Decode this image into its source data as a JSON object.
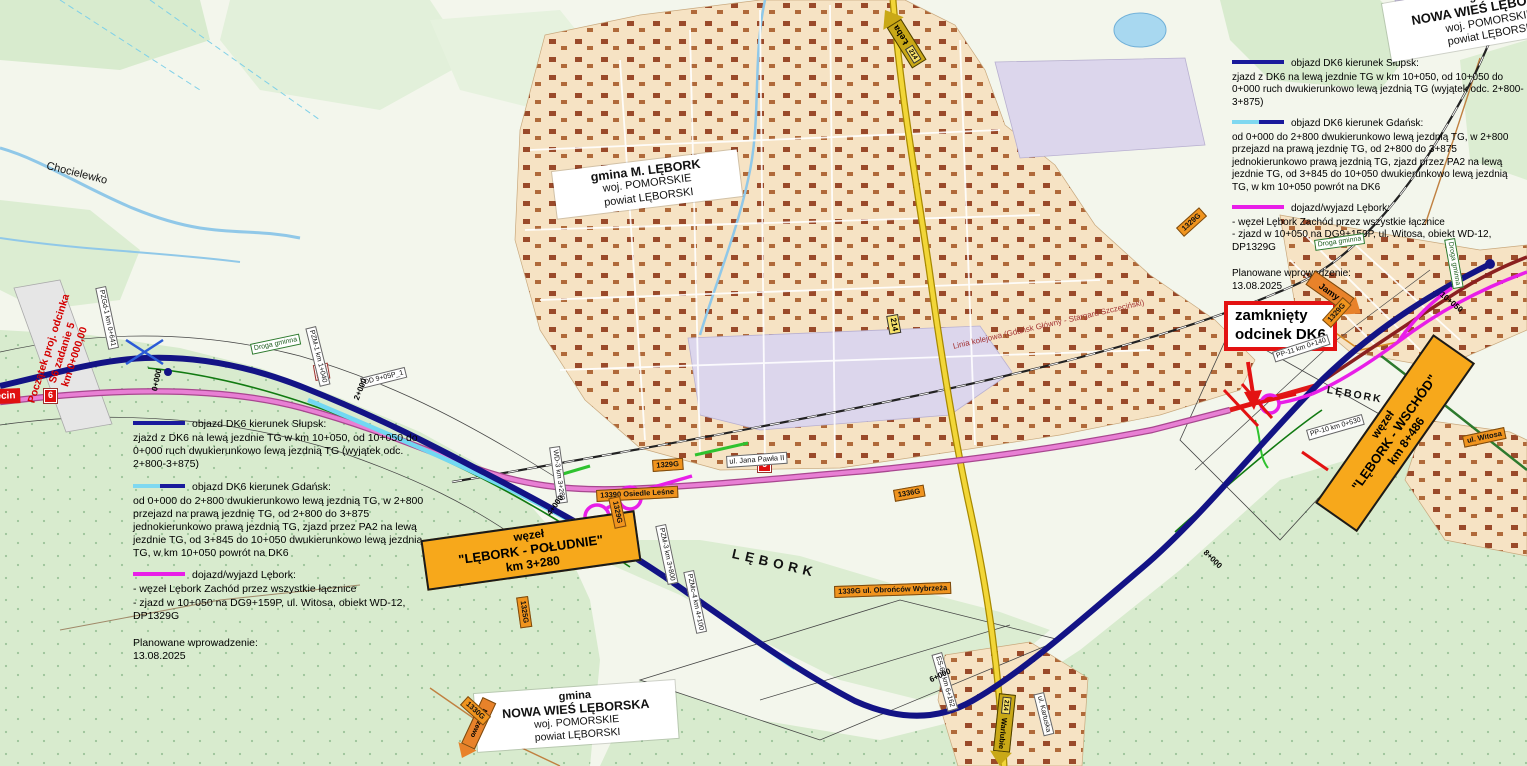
{
  "legend": {
    "items": [
      {
        "title": "objazd DK6 kierunek Słupsk:",
        "body": "zjazd z DK6 na lewą jezdnie TG w km 10+050, od 10+050 do 0+000 ruch dwukierunkowo lewą jezdnią TG (wyjątek odc. 2+800-3+875)",
        "color": "#1a1a9c"
      },
      {
        "title": "objazd DK6 kierunek Gdańsk:",
        "body": "od 0+000 do 2+800 dwukierunkowo lewą jezdnią TG, w 2+800 przejazd na prawą jezdnię TG, od 2+800 do 3+875 jednokierunkowo prawą jezdnią TG, zjazd przez PA2 na lewą jezdnie TG, od 3+845 do 10+050 dwukierunkowo lewą jezdnią TG, w km 10+050 powrót na DK6",
        "color": "#7fd8f0",
        "color2": "#1a1a9c"
      },
      {
        "title": "dojazd/wyjazd Lębork:",
        "body": "- węzeł Lębork Zachód przez wszystkie łącznice",
        "body2": "- zjazd w 10+050 na DG9+159P, ul. Witosa, obiekt WD-12, DP1329G",
        "color": "#e81ee8"
      }
    ],
    "footer_label": "Planowane wprowadzenie:",
    "footer_date": "13.08.2025"
  },
  "regions": [
    {
      "prefix": "gmina",
      "name": "NOWA WIEŚ LĘBORSKA",
      "voivodeship": "woj. POMORSKIE",
      "county": "powiat LĘBORSKI"
    },
    {
      "prefix": "",
      "name": "gmina M. LĘBORK",
      "voivodeship": "woj. POMORSKIE",
      "county": "powiat LĘBORSKI"
    },
    {
      "prefix": "gmina",
      "name": "NOWA WIEŚ LĘBORSKA",
      "voivodeship": "woj. POMORSKIE",
      "county": "powiat LĘBORSKI"
    }
  ],
  "closed_section": {
    "line1": "zamknięty",
    "line2": "odcinek DK6"
  },
  "nodes": [
    {
      "l1": "węzeł",
      "l2": "\"LĘBORK - POŁUDNIE\"",
      "l3": "km 3+280"
    },
    {
      "l1": "węzeł",
      "l2": "\"LĘBORK - WSCHÓD\"",
      "l3": "km 8+486"
    }
  ],
  "arrows": [
    {
      "label": "Łeba",
      "shield": "214"
    },
    {
      "label": "Warlubie",
      "shield": "214"
    },
    {
      "label": "Maszewo",
      "shield": ""
    },
    {
      "label": "Jamy",
      "shield": ""
    }
  ],
  "start_marker": {
    "l1": "Początek proj. odcinka",
    "l2": "S6 zadanie 5",
    "l3": "km 0+000,00"
  },
  "badges": {
    "szczecin": "Szczecin",
    "dk6": "6",
    "dw214": "214"
  },
  "places": [
    {
      "text": "Chocielewko"
    },
    {
      "text": "LĘBORK"
    },
    {
      "text": "LĘBORK"
    }
  ],
  "streets": [
    {
      "text": "ul. Jana Pawła II"
    },
    {
      "text": "ul. Kartuska"
    },
    {
      "text": "Droga gminna"
    },
    {
      "text": "Droga gminna"
    },
    {
      "text": "Droga gminna"
    },
    {
      "text": "13390 Osiedle Leśne"
    },
    {
      "text": "1339G ul. Obrońców Wybrzeża"
    },
    {
      "text": "ul. Witosa"
    }
  ],
  "shields": [
    {
      "text": "1329G"
    },
    {
      "text": "1329G"
    },
    {
      "text": "1329G"
    },
    {
      "text": "1325G"
    },
    {
      "text": "1330G"
    },
    {
      "text": "1336G"
    },
    {
      "text": "1329G"
    }
  ],
  "objects": [
    {
      "text": "PZGd-1 km 0+641"
    },
    {
      "text": "PZM-1 km 1+040"
    },
    {
      "text": "WD-3 km 3+280"
    },
    {
      "text": "PZM-3 km 3+800"
    },
    {
      "text": "PZMc-4 km 4+100"
    },
    {
      "text": "PP-11 km 0+140"
    },
    {
      "text": "PP-10 km 0+530"
    },
    {
      "text": "ES-6A km 6+162"
    },
    {
      "text": "DD 9+05P_1"
    }
  ],
  "chainage": [
    {
      "text": "0+000"
    },
    {
      "text": "2+000"
    },
    {
      "text": "4+000"
    },
    {
      "text": "6+000"
    },
    {
      "text": "8+000"
    },
    {
      "text": "10+050"
    }
  ],
  "railway_label": "Linia kolejowa (Gdańsk Główny - Stargard Szczeciński)"
}
